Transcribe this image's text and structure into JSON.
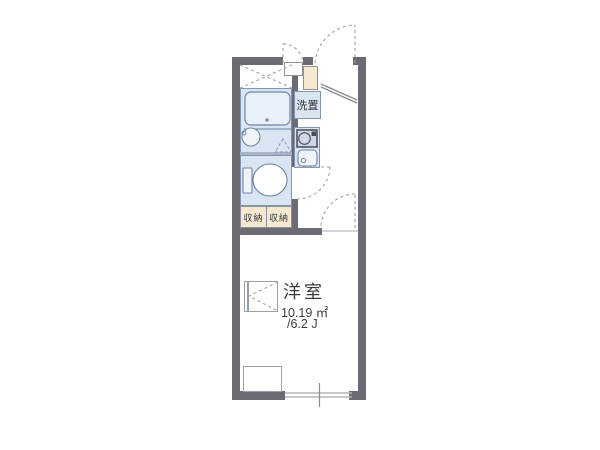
{
  "floorplan": {
    "main_room": {
      "name": "洋室",
      "area_m2": "10.19 ㎡",
      "area_tatami": "/6.2 J"
    },
    "washer_space": {
      "label": "洗置"
    },
    "storage": {
      "left_label": "収納",
      "right_label": "収納"
    },
    "icons": [
      "bathtub-icon",
      "washbasin-icon",
      "toilet-icon",
      "stove-icon",
      "kitchen-sink-icon",
      "shoe-cabinet",
      "folding-table-icon",
      "entrance-door-arc",
      "meter-box-door-arc",
      "toilet-door-arc",
      "room-door-arc",
      "window"
    ],
    "colors": {
      "wall": "#6b6b73",
      "wet_area_fill": "#dae5f3",
      "storage_fill": "#f6e9d2",
      "fixture_stroke": "#6f84a3",
      "dashed_line": "#a0a0a8",
      "text": "#3c3c3c"
    }
  }
}
